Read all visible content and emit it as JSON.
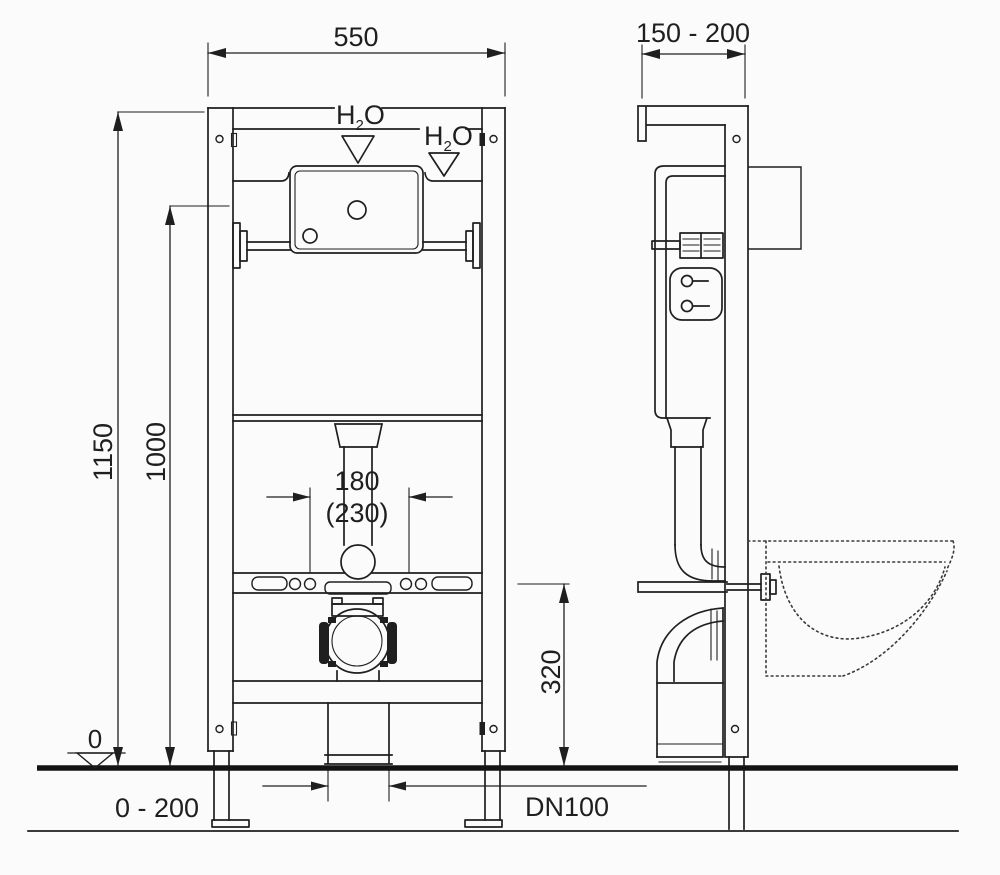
{
  "colors": {
    "line": "#1f1f1f",
    "floor": "#141414",
    "background": "#fbfbfb"
  },
  "front_view": {
    "dim_width": "550",
    "dim_overall_height": "1150",
    "dim_cistern_height": "1000",
    "dim_flush_spacing": "180",
    "dim_flush_spacing_alt": "(230)",
    "dim_drain_height": "320",
    "dim_drain_size": "DN100",
    "floor_datum": "0",
    "dim_floor_range": "0 - 200",
    "water_label": {
      "h": "H",
      "sub": "2",
      "o": "O"
    }
  },
  "side_view": {
    "dim_depth": "150 - 200"
  }
}
